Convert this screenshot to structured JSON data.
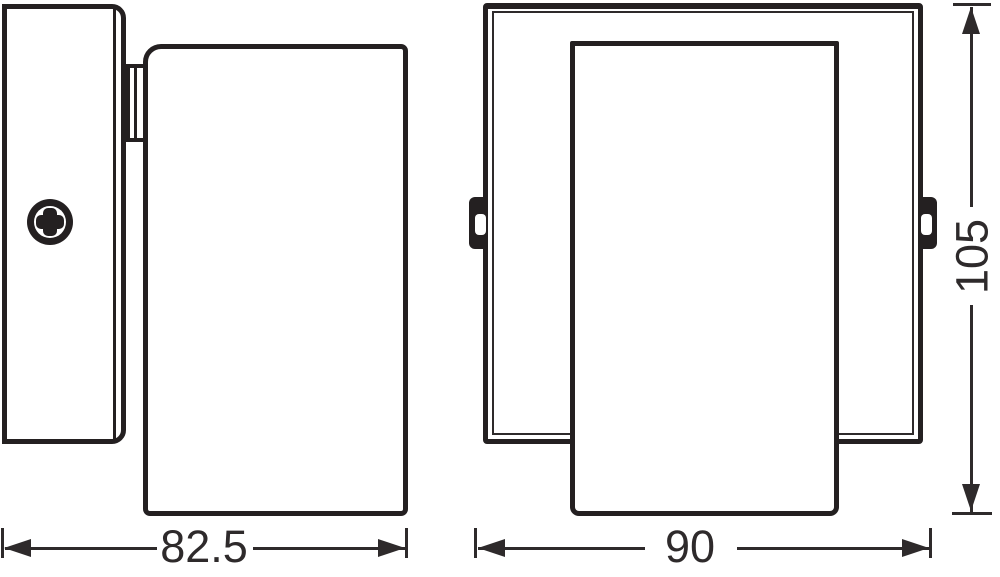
{
  "colors": {
    "ink": "#242021",
    "dimension_ink": "#2e2a2b",
    "background": "#ffffff"
  },
  "dims": {
    "side_width": "82.5",
    "front_width": "90",
    "front_height": "105"
  }
}
